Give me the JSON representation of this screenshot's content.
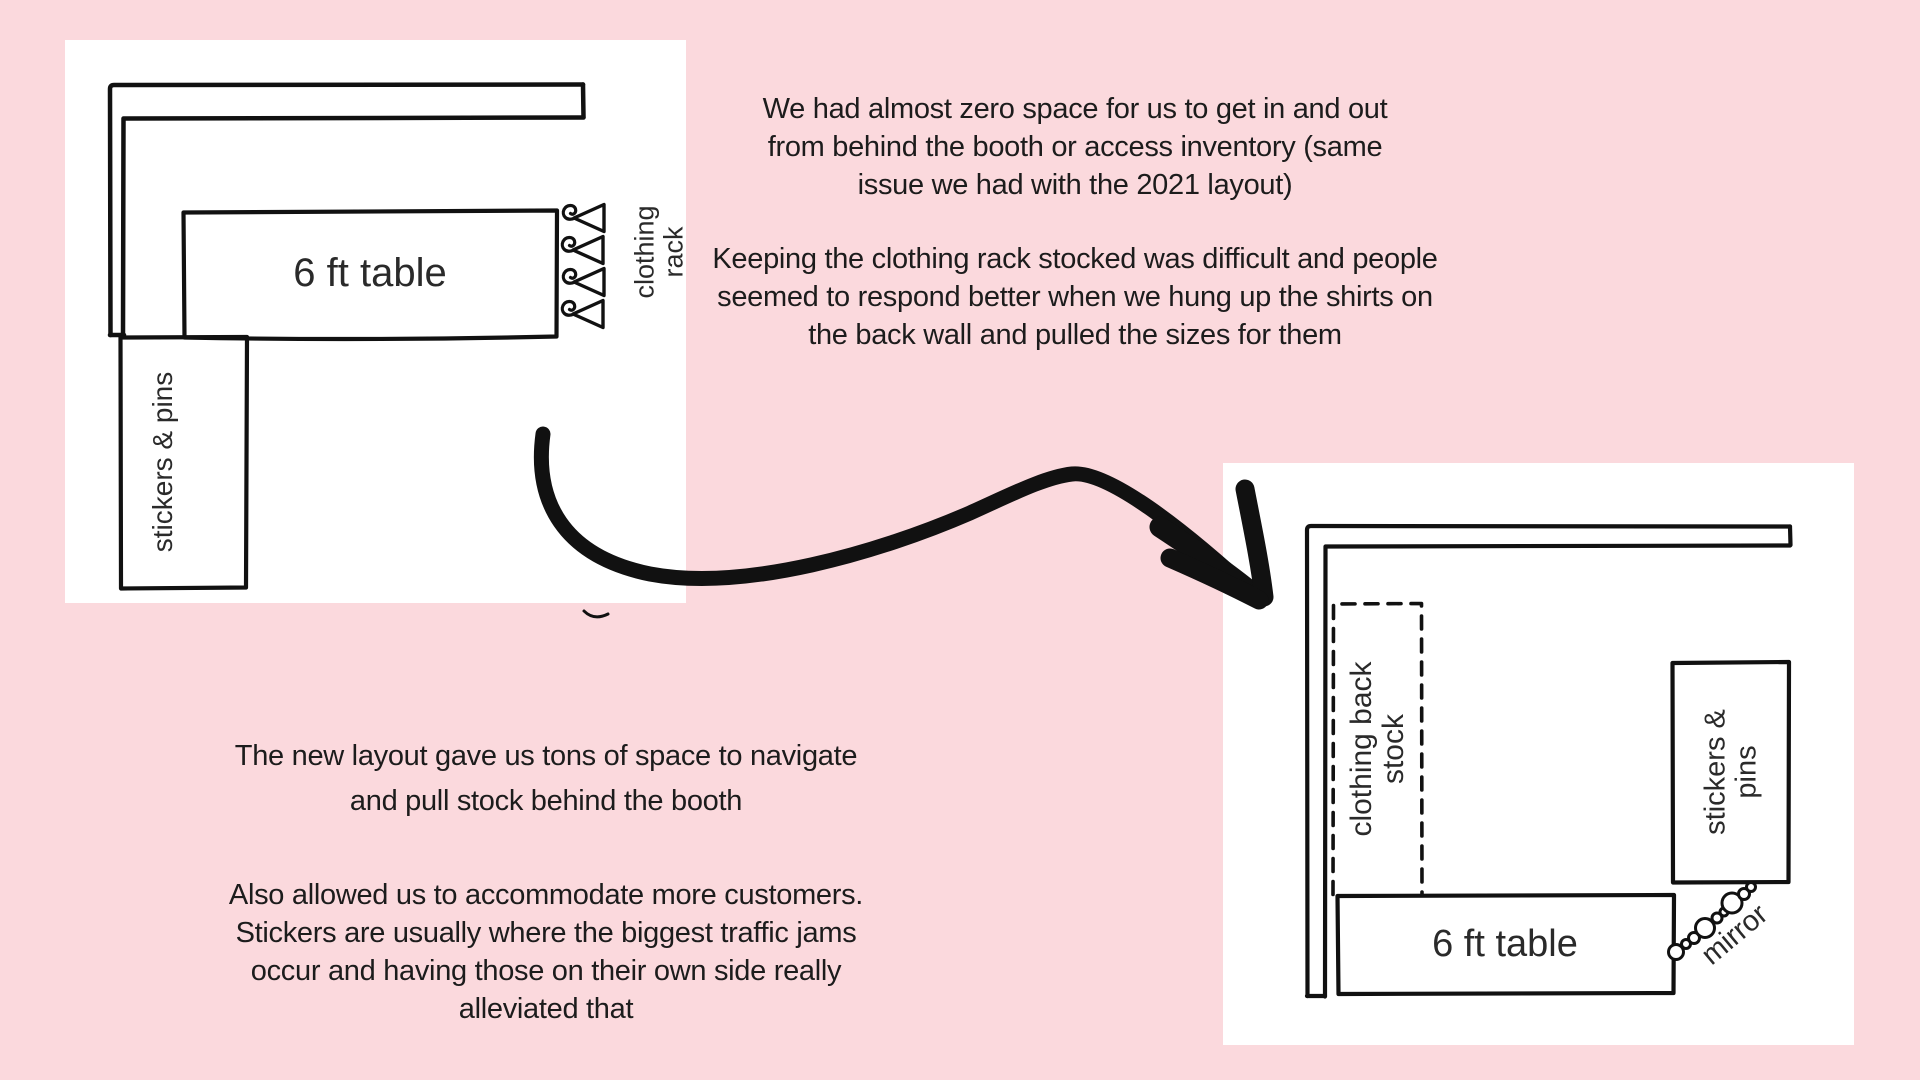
{
  "colors": {
    "background": "#fbd9dd",
    "panel": "#ffffff",
    "ink": "#111111",
    "text": "#1c1c1c"
  },
  "icons": {
    "arrow": "curved-swoosh-arrow",
    "hangers": "clothes-hanger-row",
    "mirror": "beaded-diagonal-mirror",
    "wall": "double-line-corner-wall"
  },
  "panel_old": {
    "table_label": "6 ft table",
    "stickers_label": "stickers & pins",
    "rack_label_line1": "clothing",
    "rack_label_line2": "rack"
  },
  "panel_new": {
    "table_label": "6 ft table",
    "backstock_label_line1": "clothing back",
    "backstock_label_line2": "stock",
    "stickers_label_line1": "stickers &",
    "stickers_label_line2": "pins",
    "mirror_label": "mirror"
  },
  "notes": {
    "old_issue_space": {
      "lines": [
        "We had almost zero space for us to get in and out",
        "from behind the booth or access inventory (same",
        "issue we had with the 2021 layout)"
      ]
    },
    "old_issue_rack": {
      "lines": [
        "Keeping the clothing rack stocked was difficult and people",
        "seemed to respond better when we hung up the shirts on",
        "the back wall and pulled the sizes for them"
      ]
    },
    "new_benefit_space": {
      "lines": [
        "The new layout gave us tons of space to navigate",
        "and pull stock behind the booth"
      ]
    },
    "new_benefit_customers": {
      "lines": [
        "Also allowed us to accommodate more customers.",
        "Stickers are usually where the biggest traffic jams",
        "occur and having those on their own side really",
        "alleviated that"
      ]
    }
  }
}
